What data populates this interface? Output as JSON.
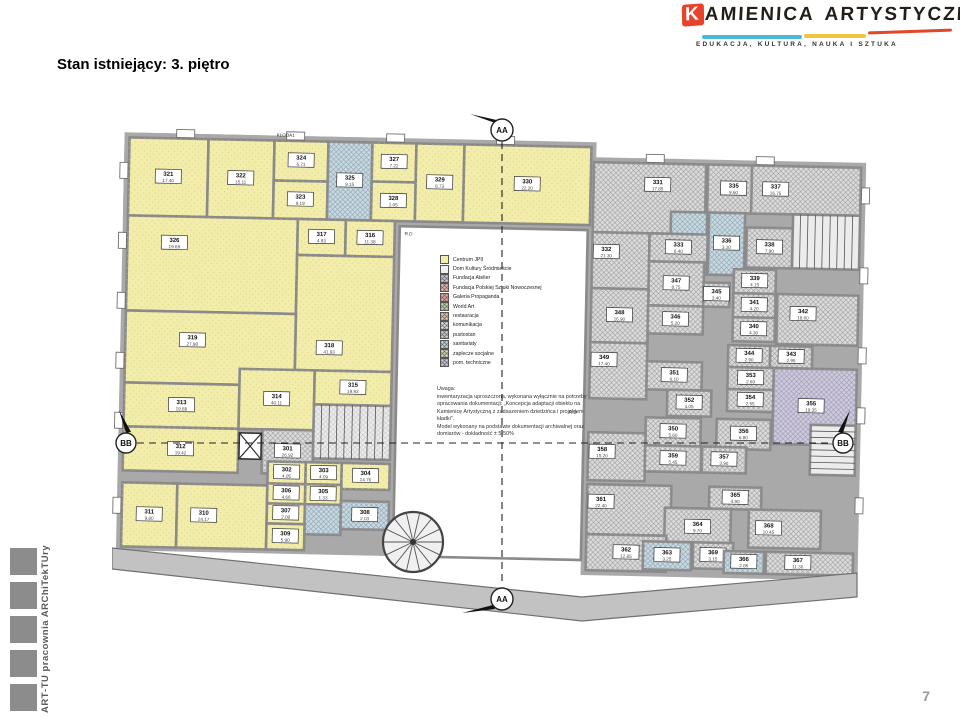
{
  "page": {
    "title": "Stan istniejący: 3. piętro",
    "page_number": "7"
  },
  "logo": {
    "k": "K",
    "word1_rest": "AMIENICA",
    "word2": "ARTYSTYCZNA",
    "subtitle": "EDUKACJA, KULTURA, NAUKA I SZTUKA",
    "accent_red": "#e8432a",
    "accent_cyan": "#49b9d6",
    "accent_yellow": "#f2c43c"
  },
  "footer_brand": {
    "part1": "ART",
    "sep": "-",
    "part2": "TU pracownia ARChiTekTUry"
  },
  "plan": {
    "markers": {
      "aa": "AA",
      "bb": "BB"
    },
    "annotations": {
      "stair_label": "KLODA1",
      "rd": "R.D"
    },
    "note": {
      "text": "Uwaga:\ninwentaryzacja uproszczona, wykonana wyłącznie na potrzeby opracowania dokumentacji: „Koncepcja adaptacji obiektu na Kamienicę Artystyczną z zadaszeniem dziedzińca i projektem kładki\".\nModel wykonany na podstawie dokumentacji archiwalnej oraz domiarów - dokładność ± 5-50%"
    },
    "legend": {
      "items": [
        {
          "label": "Centrum JPII",
          "color": "#f2edaa",
          "hatch": false
        },
        {
          "label": "Dom Kultury Śródmieście",
          "color": "#f0f0f0",
          "hatch": false
        },
        {
          "label": "Fundacja Atelier",
          "color": "#cfc8e6",
          "hatch": true
        },
        {
          "label": "Fundacja Polskiej Sztuki Nowoczesnej",
          "color": "#e3b8b0",
          "hatch": true
        },
        {
          "label": "Galeria Propaganda",
          "color": "#e8a8a0",
          "hatch": true
        },
        {
          "label": "World Art",
          "color": "#bcd8ae",
          "hatch": true
        },
        {
          "label": "restauracja",
          "color": "#e8c8a8",
          "hatch": true
        },
        {
          "label": "komunikacja",
          "color": "#e0e0e0",
          "hatch": true
        },
        {
          "label": "pustostan",
          "color": "#d0d0d0",
          "hatch": true
        },
        {
          "label": "sanitariaty",
          "color": "#bcd9e8",
          "hatch": true
        },
        {
          "label": "zaplecze socjalne",
          "color": "#d8d8b8",
          "hatch": true
        },
        {
          "label": "pom. techniczne",
          "color": "#c8ccd4",
          "hatch": true
        }
      ]
    },
    "room_fills": {
      "y": "#f2edaa",
      "h": "#dcdcdc",
      "b": "#c2dcea",
      "p": "#cfc8e6"
    },
    "rooms": [
      {
        "n": "321",
        "a": "17.40",
        "x": 13,
        "y": 45,
        "w": 79,
        "h": 78,
        "f": "y"
      },
      {
        "n": "322",
        "a": "15.11",
        "x": 92,
        "y": 45,
        "w": 66,
        "h": 78,
        "f": "y"
      },
      {
        "n": "324",
        "a": "6.71",
        "x": 158,
        "y": 45,
        "w": 54,
        "h": 40,
        "f": "y"
      },
      {
        "n": "323",
        "a": "9.19",
        "x": 158,
        "y": 85,
        "w": 54,
        "h": 38,
        "f": "y"
      },
      {
        "n": "325",
        "a": "9.15",
        "x": 212,
        "y": 45,
        "w": 44,
        "h": 78,
        "f": "b"
      },
      {
        "n": "327",
        "a": "7.22",
        "x": 256,
        "y": 45,
        "w": 44,
        "h": 39,
        "f": "y"
      },
      {
        "n": "328",
        "a": "1.05",
        "x": 256,
        "y": 84,
        "w": 44,
        "h": 39,
        "f": "y"
      },
      {
        "n": "329",
        "a": "8.73",
        "x": 300,
        "y": 45,
        "w": 48,
        "h": 78,
        "f": "y"
      },
      {
        "n": "330",
        "a": "22.20",
        "x": 348,
        "y": 45,
        "w": 127,
        "h": 78,
        "f": "y"
      },
      {
        "n": "326",
        "a": "19.69",
        "x": 13,
        "y": 123,
        "w": 170,
        "h": 95,
        "f": "y",
        "lx": 60,
        "ly": 150
      },
      {
        "n": "317",
        "a": "4.93",
        "x": 183,
        "y": 123,
        "w": 48,
        "h": 36,
        "f": "y"
      },
      {
        "n": "316",
        "a": "11.38",
        "x": 231,
        "y": 123,
        "w": 49,
        "h": 36,
        "f": "y"
      },
      {
        "n": "318",
        "a": "41.93",
        "x": 183,
        "y": 159,
        "w": 97,
        "h": 115,
        "f": "y",
        "lx": 217,
        "ly": 252
      },
      {
        "n": "319",
        "a": "27.98",
        "x": 13,
        "y": 218,
        "w": 170,
        "h": 72,
        "f": "y",
        "lx": 80,
        "ly": 247
      },
      {
        "n": "313",
        "a": "19.88",
        "x": 13,
        "y": 290,
        "w": 115,
        "h": 44,
        "f": "y"
      },
      {
        "n": "314",
        "a": "40.11",
        "x": 128,
        "y": 274,
        "w": 75,
        "h": 60,
        "f": "y"
      },
      {
        "n": "315",
        "a": "19.93",
        "x": 203,
        "y": 274,
        "w": 77,
        "h": 34,
        "f": "y"
      },
      {
        "n": "312",
        "a": "19.42",
        "x": 13,
        "y": 334,
        "w": 115,
        "h": 44,
        "f": "y"
      },
      {
        "n": "301",
        "a": "26.92",
        "x": 152,
        "y": 334,
        "w": 51,
        "h": 44,
        "f": "h"
      },
      {
        "n": "311",
        "a": "9.80",
        "x": 13,
        "y": 390,
        "w": 55,
        "h": 64,
        "f": "y"
      },
      {
        "n": "310",
        "a": "24.17",
        "x": 68,
        "y": 390,
        "w": 90,
        "h": 64,
        "f": "y",
        "lx": 95
      },
      {
        "n": "302",
        "a": "4.05",
        "x": 158,
        "y": 366,
        "w": 38,
        "h": 22,
        "f": "y"
      },
      {
        "n": "303",
        "a": "4.09",
        "x": 196,
        "y": 366,
        "w": 36,
        "h": 22,
        "f": "y"
      },
      {
        "n": "304",
        "a": "14.76",
        "x": 232,
        "y": 366,
        "w": 48,
        "h": 26,
        "f": "y"
      },
      {
        "n": "306",
        "a": "4.66",
        "x": 158,
        "y": 388,
        "w": 38,
        "h": 20,
        "f": "y"
      },
      {
        "n": "305",
        "a": "1.33",
        "x": 196,
        "y": 388,
        "w": 36,
        "h": 20,
        "f": "y"
      },
      {
        "n": "307",
        "a": "2.08",
        "x": 158,
        "y": 408,
        "w": 38,
        "h": 20,
        "f": "y"
      },
      {
        "a": "",
        "x": 196,
        "y": 408,
        "w": 36,
        "h": 30,
        "f": "b"
      },
      {
        "n": "308",
        "a": "2.03",
        "x": 232,
        "y": 404,
        "w": 48,
        "h": 28,
        "f": "b"
      },
      {
        "n": "309",
        "a": "5.90",
        "x": 158,
        "y": 428,
        "w": 38,
        "h": 26,
        "f": "y"
      },
      {
        "n": "331",
        "a": "17.85",
        "x": 478,
        "y": 60,
        "w": 112,
        "h": 70,
        "f": "h",
        "lx": 542,
        "ly": 82
      },
      {
        "n": "335",
        "a": "9.60",
        "x": 592,
        "y": 60,
        "w": 52,
        "h": 48,
        "f": "h"
      },
      {
        "n": "337",
        "a": "16.75",
        "x": 636,
        "y": 60,
        "w": 109,
        "h": 48,
        "f": "h",
        "lx": 660
      },
      {
        "n": "334",
        "a": "3.05",
        "x": 556,
        "y": 108,
        "w": 36,
        "h": 62,
        "f": "b"
      },
      {
        "n": "336",
        "a": "3.10",
        "x": 594,
        "y": 108,
        "w": 36,
        "h": 62,
        "f": "b"
      },
      {
        "n": "338",
        "a": "7.90",
        "x": 632,
        "y": 122,
        "w": 46,
        "h": 40,
        "f": "h"
      },
      {
        "n": "332",
        "a": "21.30",
        "x": 478,
        "y": 130,
        "w": 57,
        "h": 56,
        "f": "h",
        "lx": 492,
        "ly": 150
      },
      {
        "n": "333",
        "a": "6.40",
        "x": 535,
        "y": 130,
        "w": 58,
        "h": 28,
        "f": "h"
      },
      {
        "n": "347",
        "a": "8.75",
        "x": 535,
        "y": 158,
        "w": 55,
        "h": 44,
        "f": "h"
      },
      {
        "n": "345",
        "a": "3.40",
        "x": 590,
        "y": 178,
        "w": 26,
        "h": 24,
        "f": "h"
      },
      {
        "n": "348",
        "a": "16.90",
        "x": 478,
        "y": 186,
        "w": 57,
        "h": 54,
        "f": "h"
      },
      {
        "n": "349",
        "a": "17.40",
        "x": 478,
        "y": 240,
        "w": 57,
        "h": 56,
        "f": "h",
        "lx": 492,
        "ly": 258
      },
      {
        "n": "339",
        "a": "4.15",
        "x": 620,
        "y": 164,
        "w": 42,
        "h": 24,
        "f": "h"
      },
      {
        "n": "341",
        "a": "4.20",
        "x": 620,
        "y": 188,
        "w": 42,
        "h": 24,
        "f": "h"
      },
      {
        "n": "340",
        "a": "4.30",
        "x": 620,
        "y": 212,
        "w": 42,
        "h": 24,
        "f": "h"
      },
      {
        "n": "342",
        "a": "18.60",
        "x": 664,
        "y": 188,
        "w": 81,
        "h": 50,
        "f": "h",
        "lx": 690,
        "ly": 208
      },
      {
        "n": "346",
        "a": "5.20",
        "x": 535,
        "y": 202,
        "w": 55,
        "h": 28,
        "f": "h"
      },
      {
        "n": "344",
        "a": "2.90",
        "x": 616,
        "y": 240,
        "w": 42,
        "h": 22,
        "f": "h"
      },
      {
        "n": "343",
        "a": "2.95",
        "x": 658,
        "y": 240,
        "w": 42,
        "h": 22,
        "f": "h"
      },
      {
        "n": "353",
        "a": "2.60",
        "x": 616,
        "y": 262,
        "w": 46,
        "h": 22,
        "f": "h"
      },
      {
        "n": "354",
        "a": "2.55",
        "x": 616,
        "y": 284,
        "w": 46,
        "h": 22,
        "f": "h"
      },
      {
        "n": "355",
        "a": "19.35",
        "x": 662,
        "y": 262,
        "w": 83,
        "h": 76,
        "f": "p",
        "lx": 700,
        "ly": 300
      },
      {
        "n": "351",
        "a": "6.10",
        "x": 535,
        "y": 258,
        "w": 55,
        "h": 28,
        "f": "h"
      },
      {
        "n": "352",
        "a": "4.05",
        "x": 556,
        "y": 286,
        "w": 44,
        "h": 26,
        "f": "h"
      },
      {
        "n": "350",
        "a": "5.60",
        "x": 535,
        "y": 314,
        "w": 55,
        "h": 28,
        "f": "h"
      },
      {
        "n": "356",
        "a": "6.80",
        "x": 606,
        "y": 314,
        "w": 54,
        "h": 30,
        "f": "h"
      },
      {
        "n": "358",
        "a": "15.20",
        "x": 478,
        "y": 330,
        "w": 57,
        "h": 48,
        "f": "h",
        "lx": 492,
        "ly": 350
      },
      {
        "n": "359",
        "a": "5.45",
        "x": 535,
        "y": 342,
        "w": 56,
        "h": 26,
        "f": "h"
      },
      {
        "n": "357",
        "a": "3.90",
        "x": 592,
        "y": 342,
        "w": 44,
        "h": 26,
        "f": "h"
      },
      {
        "n": "361",
        "a": "22.40",
        "x": 478,
        "y": 382,
        "w": 84,
        "h": 50,
        "f": "h",
        "lx": 492,
        "ly": 400
      },
      {
        "n": "365",
        "a": "4.90",
        "x": 600,
        "y": 382,
        "w": 52,
        "h": 22,
        "f": "h"
      },
      {
        "n": "364",
        "a": "9.70",
        "x": 556,
        "y": 404,
        "w": 66,
        "h": 38,
        "f": "h"
      },
      {
        "n": "368",
        "a": "10.45",
        "x": 640,
        "y": 404,
        "w": 72,
        "h": 38,
        "f": "h",
        "lx": 660
      },
      {
        "n": "362",
        "a": "12.85",
        "x": 478,
        "y": 432,
        "w": 80,
        "h": 36,
        "f": "h"
      },
      {
        "n": "363",
        "a": "3.25",
        "x": 535,
        "y": 438,
        "w": 48,
        "h": 28,
        "f": "b"
      },
      {
        "n": "369",
        "a": "3.15",
        "x": 585,
        "y": 438,
        "w": 40,
        "h": 26,
        "f": "h"
      },
      {
        "n": "366",
        "a": "2.85",
        "x": 616,
        "y": 446,
        "w": 40,
        "h": 22,
        "f": "b"
      },
      {
        "n": "367",
        "a": "11.30",
        "x": 658,
        "y": 446,
        "w": 87,
        "h": 22,
        "f": "h",
        "lx": 690
      }
    ]
  }
}
